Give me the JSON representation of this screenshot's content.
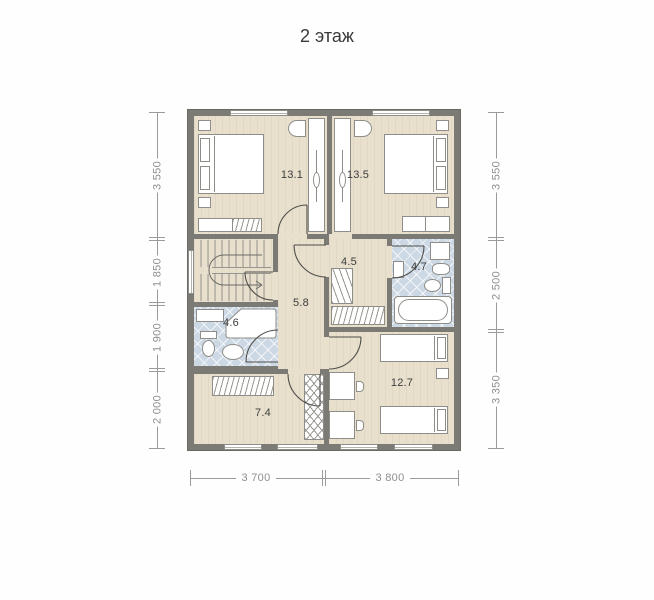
{
  "title": "2 этаж",
  "rooms": {
    "bedroom_left": "13.1",
    "bedroom_right": "13.5",
    "dressing": "4.5",
    "bathroom_right": "4.7",
    "hall": "5.8",
    "bathroom_left": "4.6",
    "storage": "7.4",
    "bedroom_bottom": "12.7"
  },
  "dimensions": {
    "left": [
      "3 550",
      "1 850",
      "1 900",
      "2 000"
    ],
    "right": [
      "3 550",
      "2 500",
      "3 350"
    ],
    "bottom": [
      "3 700",
      "3 800"
    ]
  },
  "colors": {
    "wall": "#7b7a75",
    "floor": "#e8e0cd",
    "tile": "#ccd8e4",
    "furniture_outline": "#8e8d88",
    "door_line": "#4f4e4a",
    "dimension": "#9b9b9b",
    "label_text": "#3d3d3d"
  }
}
